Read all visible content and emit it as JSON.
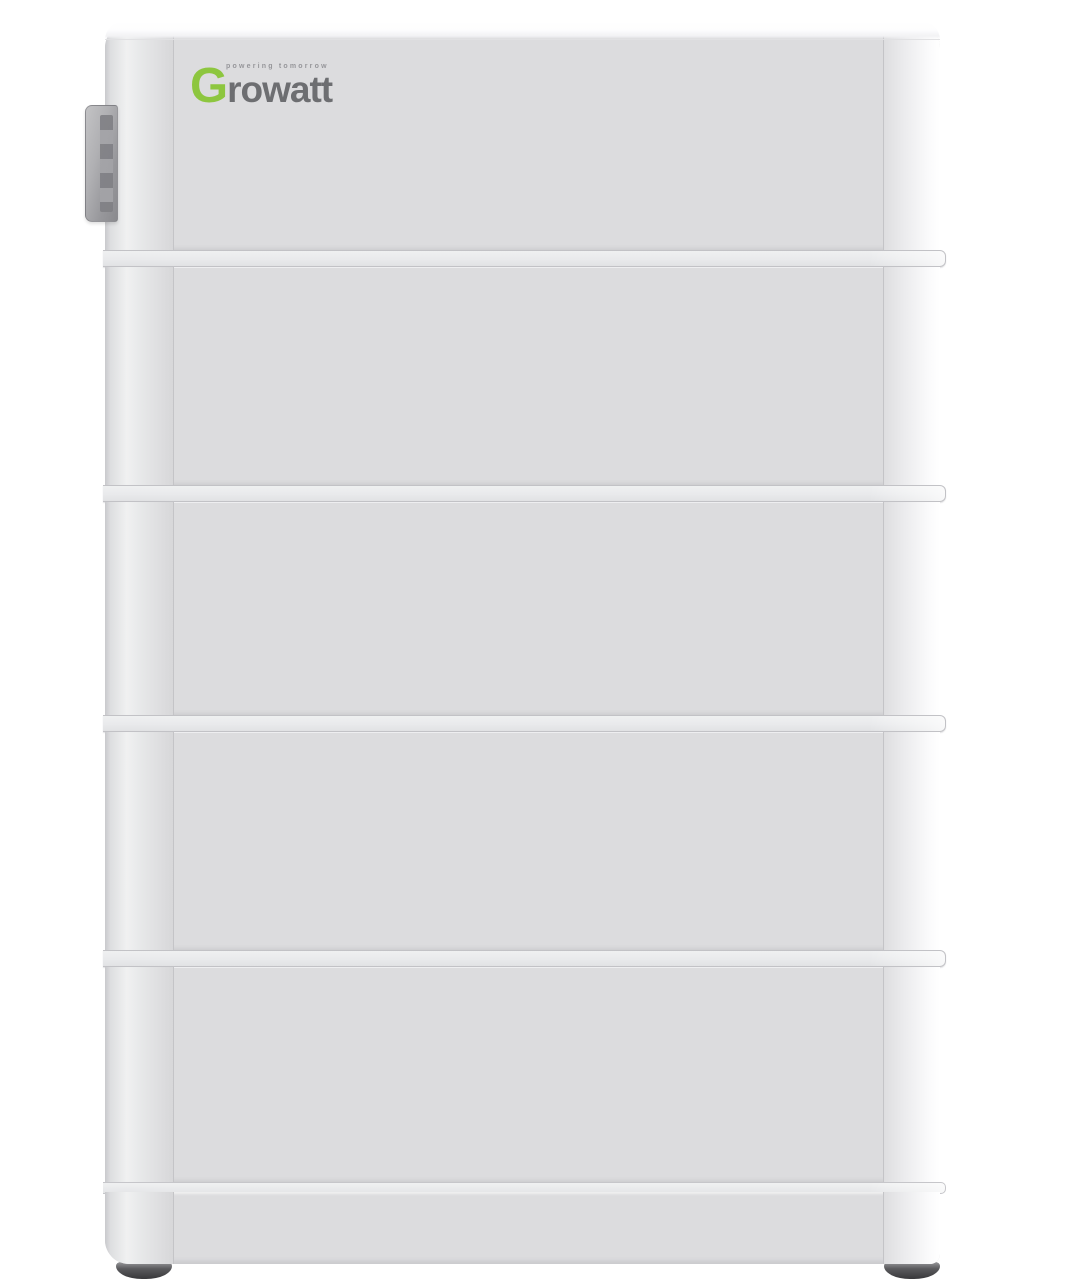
{
  "product": {
    "name": "Growatt stacked battery energy storage tower",
    "module_count": 5,
    "visible_parts": [
      "top battery module with brand logo",
      "three middle battery modules",
      "bottom battery module",
      "plinth base",
      "two rubber feet",
      "side mounting bracket"
    ]
  },
  "logo": {
    "letter": "G",
    "word": "rowatt",
    "tagline": "powering tomorrow"
  },
  "colors": {
    "background": "#ffffff",
    "body": "#dcdcde",
    "seam": "#c4c4c7",
    "logo_green": "#8dc63f",
    "logo_gray": "#6d6e71",
    "tagline_gray": "#96969a",
    "foot_dark": "#434346",
    "bracket_gray": "#a5a5a9"
  }
}
